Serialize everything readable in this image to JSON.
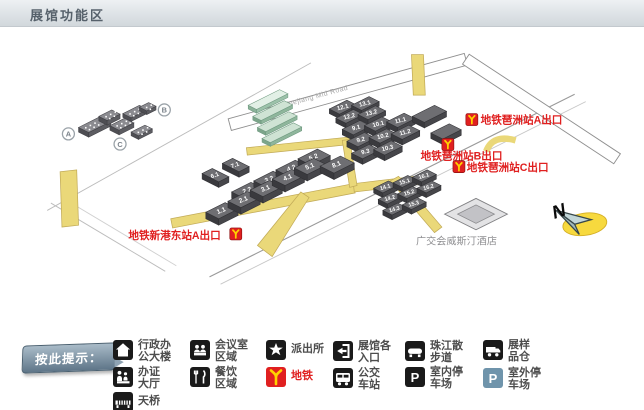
{
  "header": {
    "title": "展馆功能区"
  },
  "map": {
    "road_label": "Yuejiang Mid Road",
    "compass_label": "N",
    "hotel_label": "广交会威斯汀酒店",
    "clusters": [
      {
        "label": "A"
      },
      {
        "label": "B"
      },
      {
        "label": "C"
      }
    ],
    "metro_exits": [
      {
        "label": "地铁琶洲站A出口"
      },
      {
        "label": "地铁琶洲站B出口"
      },
      {
        "label": "地铁琶洲站C出口"
      },
      {
        "label": "地铁新港东站A出口"
      }
    ],
    "halls": {
      "area_a_lower": [
        "1.1",
        "2.1",
        "3.1",
        "4.1",
        "5.1"
      ],
      "area_a_upper": [
        "2.2",
        "3.2",
        "4.2",
        "5.2"
      ],
      "area_a_north": [
        "6.1",
        "7.1"
      ],
      "area_a_east": [
        "8.1"
      ],
      "area_b_north": [
        "12.1",
        "13.1"
      ],
      "area_b_north2": [
        "12.2",
        "13.2"
      ],
      "area_b_row1": [
        "9.1",
        "10.1",
        "11.1"
      ],
      "area_b_row2": [
        "9.2",
        "10.2",
        "11.2"
      ],
      "area_b_row3": [
        "9.3",
        "10.3"
      ],
      "area_c_row1": [
        "14.1",
        "15.1",
        "16.1"
      ],
      "area_c_row2": [
        "14.2",
        "15.2",
        "16.2"
      ],
      "area_c_row3": [
        "14.3",
        "15.3"
      ]
    }
  },
  "legend": {
    "ribbon": "按此提示：",
    "items": [
      {
        "icon": "office-building-icon",
        "lines": [
          "行政办",
          "公大楼"
        ]
      },
      {
        "icon": "meeting-room-icon",
        "lines": [
          "会议室",
          "区域"
        ]
      },
      {
        "icon": "police-station-icon",
        "lines": [
          "派出所"
        ]
      },
      {
        "icon": "entrance-icon",
        "lines": [
          "展馆各",
          "入口"
        ]
      },
      {
        "icon": "riverside-walk-icon",
        "lines": [
          "珠江散",
          "步道"
        ]
      },
      {
        "icon": "sample-warehouse-icon",
        "lines": [
          "展样",
          "品仓"
        ]
      },
      {
        "icon": "service-hall-icon",
        "lines": [
          "办证",
          "大厅"
        ]
      },
      {
        "icon": "dining-icon",
        "lines": [
          "餐饮",
          "区域"
        ]
      },
      {
        "icon": "metro-icon",
        "lines": [
          "地铁"
        ],
        "color": "#e02020"
      },
      {
        "icon": "bus-station-icon",
        "lines": [
          "公交",
          "车站"
        ]
      },
      {
        "icon": "indoor-parking-icon",
        "lines": [
          "室内停",
          "车场"
        ]
      },
      {
        "icon": "outdoor-parking-icon",
        "lines": [
          "室外停",
          "车场"
        ]
      },
      {
        "icon": "footbridge-icon",
        "lines": [
          "天桥"
        ]
      }
    ]
  },
  "colors": {
    "metro_red": "#e02020",
    "metro_yellow": "#ffd200",
    "walkway_yellow": "#ead879",
    "hall_gray": "#6e6e72",
    "outdoor_parking_blue": "#6f94ab"
  }
}
